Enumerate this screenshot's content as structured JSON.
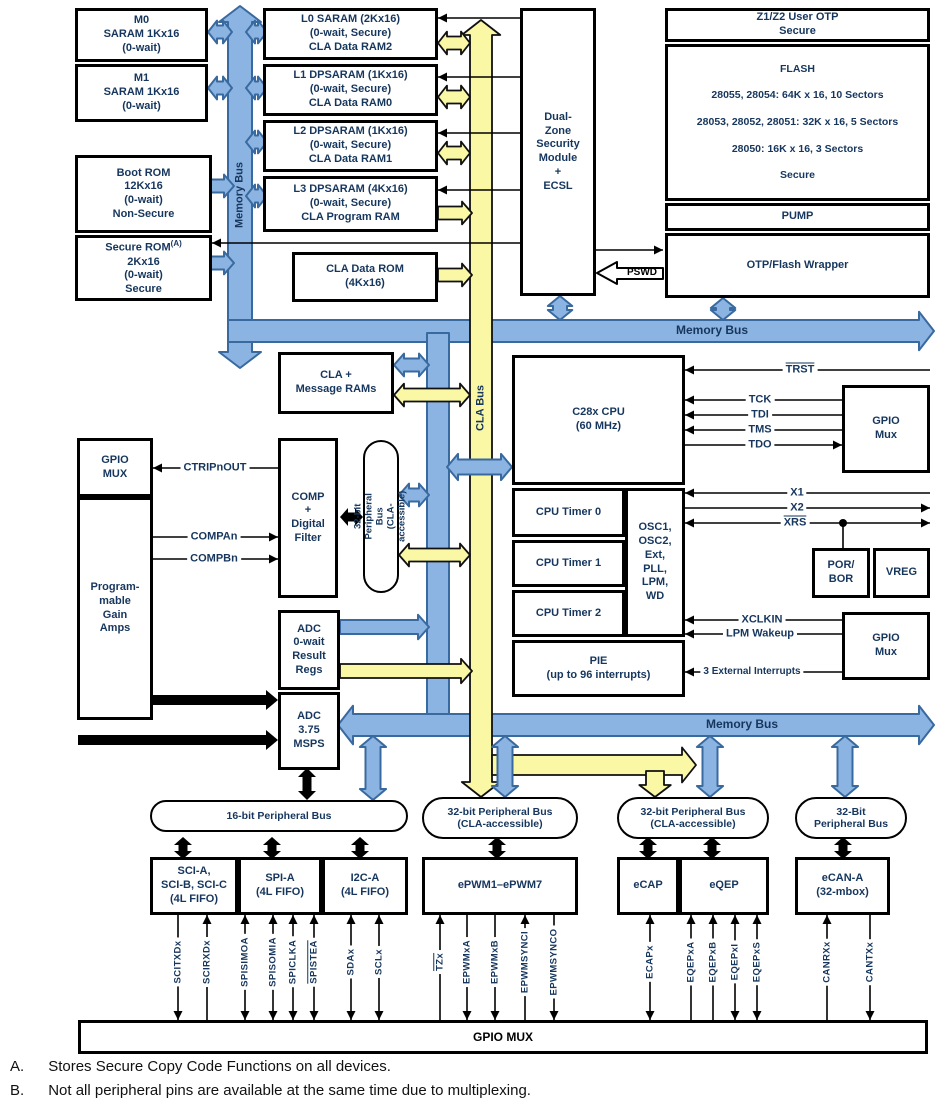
{
  "colors": {
    "bus_blue": "#8CB4E2",
    "bus_blue_stroke": "#38699F",
    "bus_yellow": "#FAF8A4",
    "text_navy": "#16365D"
  },
  "blocks": {
    "m0": "M0\nSARAM 1Kx16\n(0-wait)",
    "m1": "M1\nSARAM 1Kx16\n(0-wait)",
    "boot_rom": "Boot ROM\n12Kx16\n(0-wait)\nNon-Secure",
    "secure_rom": {
      "name": "Secure ROM",
      "sup": "(A)",
      "rest": "2Kx16\n(0-wait)\nSecure"
    },
    "l0": "L0 SARAM (2Kx16)\n(0-wait, Secure)\nCLA Data RAM2",
    "l1": "L1 DPSARAM (1Kx16)\n(0-wait, Secure)\nCLA Data RAM0",
    "l2": "L2 DPSARAM (1Kx16)\n(0-wait, Secure)\nCLA Data RAM1",
    "l3": "L3 DPSARAM (4Kx16)\n(0-wait, Secure)\nCLA Program RAM",
    "cla_rom": "CLA Data ROM\n(4Kx16)",
    "dzsm": "Dual-\nZone\nSecurity\nModule\n+\nECSL",
    "z1z2": "Z1/Z2 User OTP\nSecure",
    "flash": {
      "title": "FLASH",
      "l1": "28055, 28054: 64K x 16, 10 Sectors",
      "l2": "28053, 28052, 28051: 32K x 16, 5 Sectors",
      "l3": "28050: 16K x 16, 3 Sectors",
      "footer": "Secure"
    },
    "pump": "PUMP",
    "wrapper": "OTP/Flash Wrapper",
    "cla_msg": "CLA +\nMessage RAMs",
    "cpu": "C28x CPU\n(60 MHz)",
    "timer0": "CPU Timer 0",
    "timer1": "CPU Timer 1",
    "timer2": "CPU Timer 2",
    "osc": "OSC1,\nOSC2,\nExt,\nPLL,\nLPM,\nWD",
    "pie": "PIE\n(up to 96 interrupts)",
    "gpio_mux_jtag": "GPIO\nMux",
    "por_bor": "POR/\nBOR",
    "vreg": "VREG",
    "gpio_mux_wake": "GPIO\nMux",
    "gpio_mux_left": "GPIO\nMUX",
    "pga": "Program-\nmable\nGain\nAmps",
    "comp": "COMP\n+\nDigital\nFilter",
    "adc_result": "ADC\n0-wait\nResult\nRegs",
    "adc_msps": "ADC\n3.75\nMSPS",
    "sci": "SCI-A,\nSCI-B, SCI-C\n(4L FIFO)",
    "spi": "SPI-A\n(4L FIFO)",
    "i2c": "I2C-A\n(4L FIFO)",
    "epwm": "ePWM1–ePWM7",
    "ecap": "eCAP",
    "eqep": "eQEP",
    "ecan": "eCAN-A\n(32-mbox)",
    "gpio_mux_bottom": "GPIO MUX"
  },
  "buses": {
    "memory_bus_v": "Memory Bus",
    "memory_bus_top": "Memory Bus",
    "memory_bus_bottom": "Memory Bus",
    "cla_bus": "CLA Bus",
    "pb16": "16-bit Peripheral Bus",
    "pb32_vert": "32-bit Peripheral Bus\n(CLA-accessible)",
    "pb32_a": "32-bit Peripheral Bus\n(CLA-accessible)",
    "pb32_b": "32-bit Peripheral Bus\n(CLA-accessible)",
    "pb32_c": "32-Bit\nPeripheral Bus"
  },
  "nets": {
    "trst": "TRST",
    "tck": "TCK",
    "tdi": "TDI",
    "tms": "TMS",
    "tdo": "TDO",
    "x1": "X1",
    "x2": "X2",
    "xrs": "XRS",
    "xclkin": "XCLKIN",
    "lpm": "LPM Wakeup",
    "ext_int": "3 External Interrupts",
    "pswd": "PSWD",
    "ctrip": "CTRIPnOUT",
    "compan": "COMPAn",
    "compbn": "COMPBn"
  },
  "pins": [
    {
      "label": "SCITXDx",
      "overline": false
    },
    {
      "label": "SCIRXDx",
      "overline": false
    },
    {
      "label": "SPISIMOA",
      "overline": false
    },
    {
      "label": "SPISOMIA",
      "overline": false
    },
    {
      "label": "SPICLKA",
      "overline": false
    },
    {
      "label": "SPISTEA",
      "overline": true
    },
    {
      "label": "SDAx",
      "overline": false
    },
    {
      "label": "SCLx",
      "overline": false
    },
    {
      "label": "TZx",
      "overline": true
    },
    {
      "label": "EPWMxA",
      "overline": false
    },
    {
      "label": "EPWMxB",
      "overline": false
    },
    {
      "label": "EPWMSYNCI",
      "overline": false
    },
    {
      "label": "EPWMSYNCO",
      "overline": false
    },
    {
      "label": "ECAPx",
      "overline": false
    },
    {
      "label": "EQEPxA",
      "overline": false
    },
    {
      "label": "EQEPxB",
      "overline": false
    },
    {
      "label": "EQEPxI",
      "overline": false
    },
    {
      "label": "EQEPxS",
      "overline": false
    },
    {
      "label": "CANRXx",
      "overline": false
    },
    {
      "label": "CANTXx",
      "overline": false
    }
  ],
  "notes": {
    "a_id": "A.",
    "a_text": "Stores Secure Copy Code Functions on all devices.",
    "b_id": "B.",
    "b_text": "Not all peripheral pins are available at the same time due to multiplexing."
  }
}
